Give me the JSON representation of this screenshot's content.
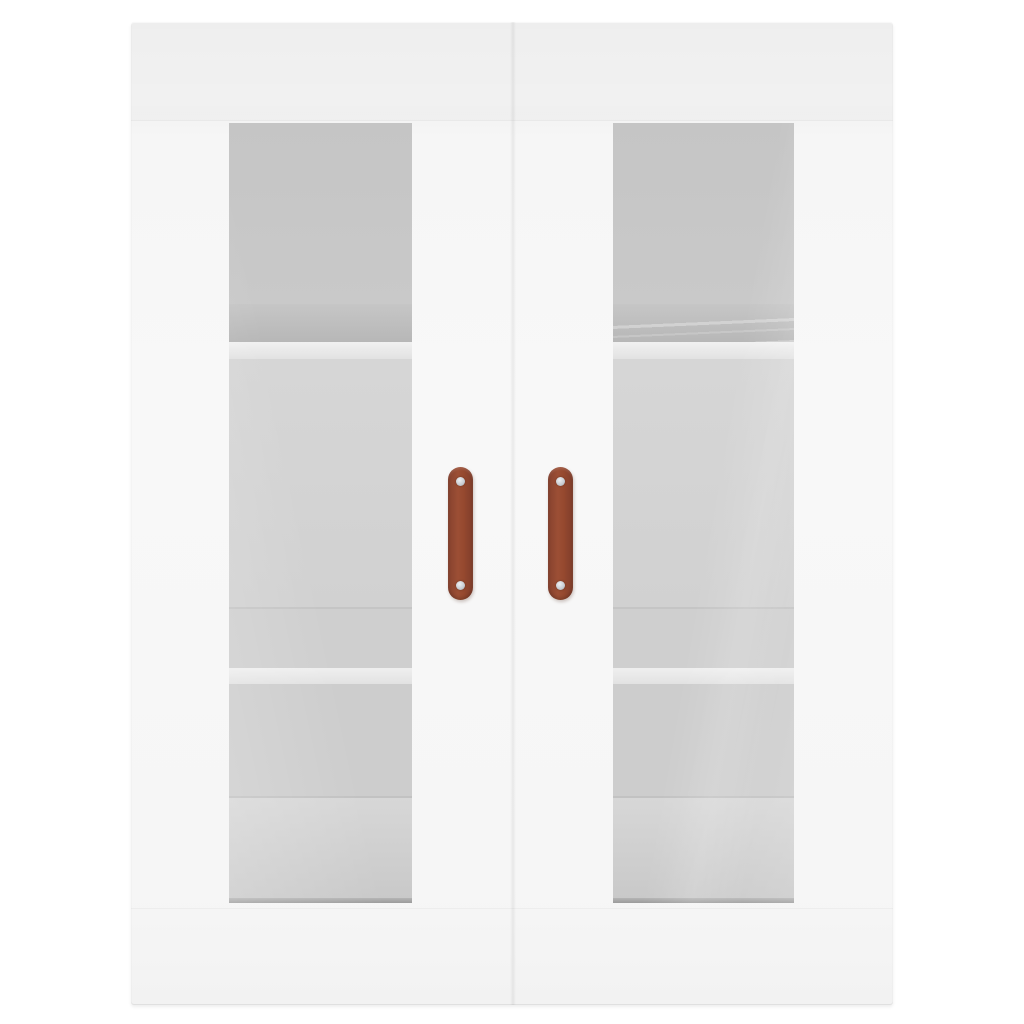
{
  "image": {
    "subject": "White wall-mounted cabinet with two frosted glass doors and brown handles",
    "background_color": "#ffffff"
  },
  "colors": {
    "background": "#ffffff",
    "cabinet_face": "#f6f6f6",
    "cabinet_top_band": "#f3f3f3",
    "cabinet_edge_shadow": "#e0e0e0",
    "glass_base": "#c9c9c9",
    "glass_shadow_band": "#b7b7b7",
    "shelf_front_strip": "#e2e2e2",
    "glass_bottom_edge": "#9c9c9c",
    "handle_base": "#96492f",
    "handle_highlight": "#9c4f35",
    "handle_shadow": "#86412e",
    "screw": "#c6cbd1"
  },
  "structure": {
    "doors": 2,
    "glass_panels": 2,
    "handles": 2,
    "screws_per_handle": 2,
    "visible_shelf_edges_per_door": 2
  }
}
